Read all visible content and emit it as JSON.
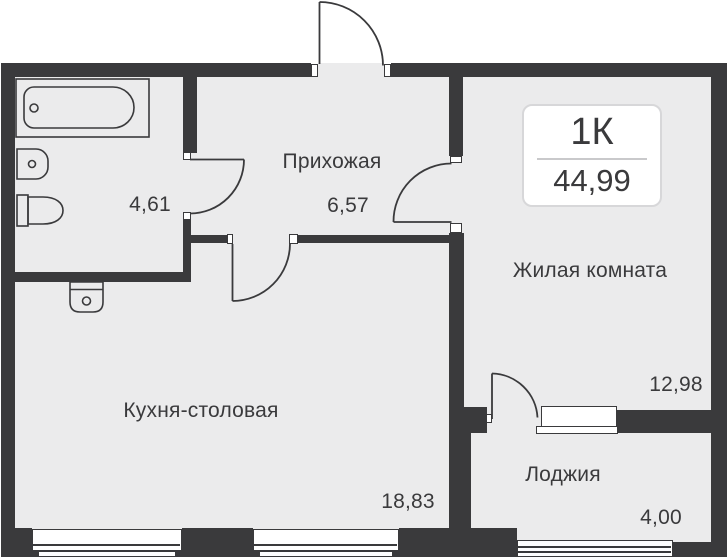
{
  "plan": {
    "unit": {
      "type_label": "1К",
      "total_area": "44,99"
    },
    "rooms": {
      "hallway": {
        "name": "Прихожая",
        "area": "6,57"
      },
      "bathroom": {
        "area": "4,61"
      },
      "living": {
        "name": "Жилая комната",
        "area": "12,98"
      },
      "kitchen": {
        "name": "Кухня-столовая",
        "area": "18,83"
      },
      "loggia": {
        "name": "Лоджия",
        "area": "4,00"
      }
    },
    "colors": {
      "wall": "#3a3a3c",
      "floor": "#ebebec",
      "text": "#3a3a3c",
      "unit_box_border": "#d7d7d9",
      "unit_box_divider": "#c9c9cb"
    }
  }
}
